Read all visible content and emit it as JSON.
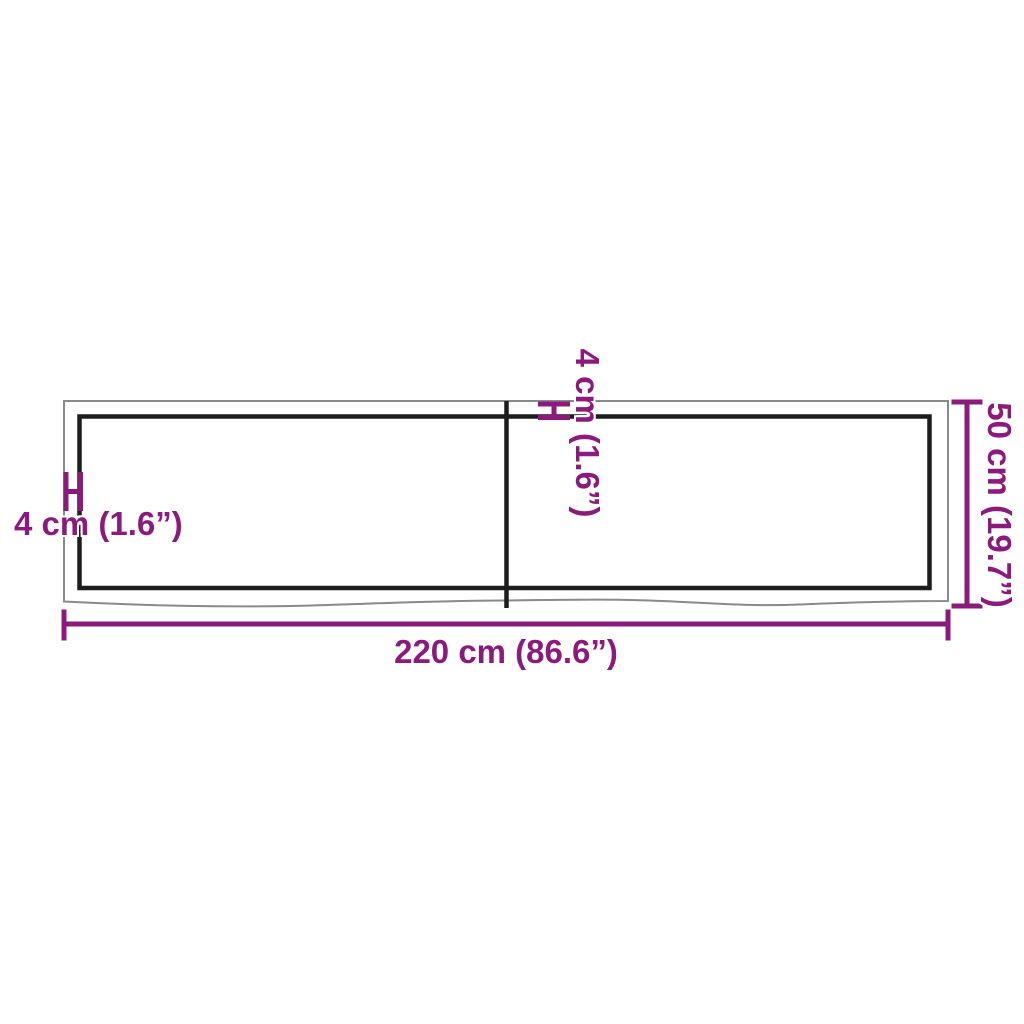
{
  "diagram": {
    "title": "product-dimension-diagram",
    "labels": {
      "width": "220 cm (86.6”)",
      "height": "50 cm (19.7”)",
      "thickness_left": "4 cm (1.6”)",
      "thickness_top": "4 cm (1.6”)"
    },
    "measurements": {
      "width_cm": "220",
      "width_in": "86.6",
      "height_cm": "50",
      "height_in": "19.7",
      "thickness_cm": "4",
      "thickness_in": "1.6"
    }
  },
  "colors": {
    "accent": "#8c1a7d",
    "outline_gray": "#8a8a8a",
    "outline_black": "#1d1d1d",
    "background": "#ffffff"
  }
}
